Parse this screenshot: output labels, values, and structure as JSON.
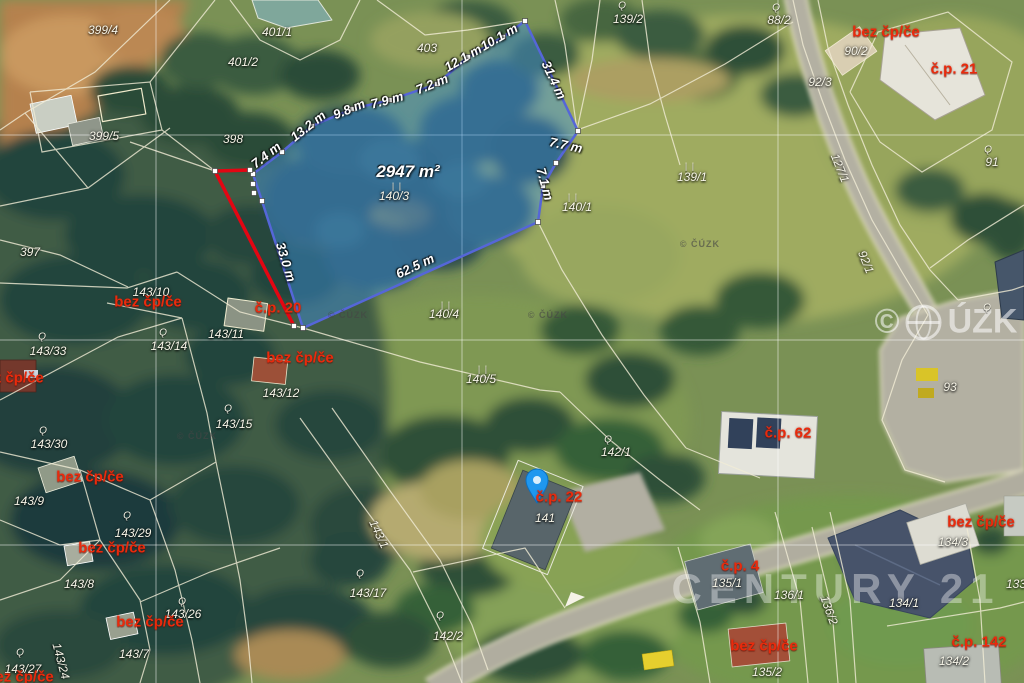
{
  "map": {
    "area_label": "2947 m²",
    "parcel_labels": [
      {
        "text": "399/4",
        "x": 103,
        "y": 30
      },
      {
        "text": "401/1",
        "x": 277,
        "y": 32
      },
      {
        "text": "401/2",
        "x": 243,
        "y": 62
      },
      {
        "text": "403",
        "x": 427,
        "y": 48
      },
      {
        "text": "399/5",
        "x": 104,
        "y": 136
      },
      {
        "text": "398",
        "x": 233,
        "y": 139
      },
      {
        "text": "397",
        "x": 30,
        "y": 252
      },
      {
        "text": "139/2",
        "x": 628,
        "y": 19
      },
      {
        "text": "88/2",
        "x": 779,
        "y": 20
      },
      {
        "text": "90/2",
        "x": 856,
        "y": 51
      },
      {
        "text": "92/3",
        "x": 820,
        "y": 82
      },
      {
        "text": "91",
        "x": 992,
        "y": 162
      },
      {
        "text": "139/1",
        "x": 692,
        "y": 177
      },
      {
        "text": "127/1",
        "x": 840,
        "y": 168,
        "rot": 68
      },
      {
        "text": "92/1",
        "x": 866,
        "y": 262,
        "rot": 68
      },
      {
        "text": "140/3",
        "x": 394,
        "y": 196
      },
      {
        "text": "140/1",
        "x": 577,
        "y": 207
      },
      {
        "text": "140/4",
        "x": 444,
        "y": 314
      },
      {
        "text": "140/5",
        "x": 481,
        "y": 379
      },
      {
        "text": "143/10",
        "x": 151,
        "y": 292
      },
      {
        "text": "143/11",
        "x": 226,
        "y": 334
      },
      {
        "text": "143/33",
        "x": 48,
        "y": 351
      },
      {
        "text": "143/14",
        "x": 169,
        "y": 346
      },
      {
        "text": "143/12",
        "x": 281,
        "y": 393
      },
      {
        "text": "143/15",
        "x": 234,
        "y": 424
      },
      {
        "text": "143/30",
        "x": 49,
        "y": 444
      },
      {
        "text": "143/9",
        "x": 29,
        "y": 501
      },
      {
        "text": "143/29",
        "x": 133,
        "y": 533
      },
      {
        "text": "143/8",
        "x": 79,
        "y": 584
      },
      {
        "text": "143/26",
        "x": 183,
        "y": 614
      },
      {
        "text": "143/7",
        "x": 134,
        "y": 654
      },
      {
        "text": "143/27",
        "x": 23,
        "y": 669
      },
      {
        "text": "143/24",
        "x": 61,
        "y": 661,
        "rot": 75
      },
      {
        "text": "143/1",
        "x": 379,
        "y": 534,
        "rot": 65
      },
      {
        "text": "143/17",
        "x": 368,
        "y": 593
      },
      {
        "text": "142/1",
        "x": 616,
        "y": 452
      },
      {
        "text": "142/2",
        "x": 448,
        "y": 636
      },
      {
        "text": "141",
        "x": 545,
        "y": 518
      },
      {
        "text": "135/1",
        "x": 727,
        "y": 583
      },
      {
        "text": "136/1",
        "x": 789,
        "y": 595
      },
      {
        "text": "136/2",
        "x": 829,
        "y": 610,
        "rot": 70
      },
      {
        "text": "134/1",
        "x": 904,
        "y": 603
      },
      {
        "text": "134/3",
        "x": 953,
        "y": 542
      },
      {
        "text": "134/2",
        "x": 954,
        "y": 661
      },
      {
        "text": "135/2",
        "x": 767,
        "y": 672
      },
      {
        "text": "133",
        "x": 1016,
        "y": 584
      },
      {
        "text": "93",
        "x": 950,
        "y": 387
      }
    ],
    "red_labels": [
      {
        "text": "bez čp/če",
        "x": 886,
        "y": 32
      },
      {
        "text": "č.p. 21",
        "x": 954,
        "y": 69
      },
      {
        "text": "bez čp/če",
        "x": 148,
        "y": 302
      },
      {
        "text": "č.p. 20",
        "x": 278,
        "y": 308
      },
      {
        "text": "bez čp/če",
        "x": 300,
        "y": 358
      },
      {
        "text": "bez čp/če",
        "x": 10,
        "y": 378
      },
      {
        "text": "bez čp/če",
        "x": 90,
        "y": 477
      },
      {
        "text": "bez čp/če",
        "x": 112,
        "y": 548
      },
      {
        "text": "bez čp/če",
        "x": 150,
        "y": 622
      },
      {
        "text": "bez čp/če",
        "x": 20,
        "y": 677
      },
      {
        "text": "č.p. 62",
        "x": 788,
        "y": 433
      },
      {
        "text": "č.p. 22",
        "x": 559,
        "y": 497
      },
      {
        "text": "č.p. 4",
        "x": 740,
        "y": 566
      },
      {
        "text": "bez čp/če",
        "x": 981,
        "y": 522
      },
      {
        "text": "bez čp/če",
        "x": 764,
        "y": 646
      },
      {
        "text": "č.p. 142",
        "x": 979,
        "y": 642
      }
    ],
    "dimension_labels": [
      {
        "text": "7.4 m",
        "x": 266,
        "y": 155,
        "rot": -38
      },
      {
        "text": "13.2 m",
        "x": 308,
        "y": 126,
        "rot": -38
      },
      {
        "text": "9.8 m",
        "x": 349,
        "y": 109,
        "rot": -22
      },
      {
        "text": "7.9 m",
        "x": 387,
        "y": 100,
        "rot": -15
      },
      {
        "text": "7.2 m",
        "x": 432,
        "y": 84,
        "rot": -22
      },
      {
        "text": "12.1 m",
        "x": 463,
        "y": 58,
        "rot": -30
      },
      {
        "text": "10.1 m",
        "x": 499,
        "y": 37,
        "rot": -30
      },
      {
        "text": "31.4 m",
        "x": 554,
        "y": 80,
        "rot": 65
      },
      {
        "text": "7.7 m",
        "x": 566,
        "y": 145,
        "rot": 12
      },
      {
        "text": "7.1 m",
        "x": 545,
        "y": 184,
        "rot": 75
      },
      {
        "text": "62.5 m",
        "x": 415,
        "y": 266,
        "rot": -25
      },
      {
        "text": "33.0 m",
        "x": 286,
        "y": 262,
        "rot": 73
      }
    ],
    "symbols": {
      "grass_glyph": "| |",
      "grass_positions": [
        {
          "x": 397,
          "y": 186
        },
        {
          "x": 446,
          "y": 305
        },
        {
          "x": 483,
          "y": 369
        },
        {
          "x": 690,
          "y": 166
        },
        {
          "x": 573,
          "y": 197
        }
      ],
      "building_glyph": "Ǫ",
      "building_positions": [
        {
          "x": 622,
          "y": 6
        },
        {
          "x": 776,
          "y": 8
        },
        {
          "x": 988,
          "y": 150
        },
        {
          "x": 42,
          "y": 337
        },
        {
          "x": 163,
          "y": 333
        },
        {
          "x": 43,
          "y": 431
        },
        {
          "x": 228,
          "y": 409
        },
        {
          "x": 127,
          "y": 516
        },
        {
          "x": 182,
          "y": 602
        },
        {
          "x": 20,
          "y": 653
        },
        {
          "x": 360,
          "y": 574
        },
        {
          "x": 440,
          "y": 616
        },
        {
          "x": 608,
          "y": 440
        },
        {
          "x": 987,
          "y": 308
        }
      ]
    },
    "watermarks": {
      "small": {
        "text": "© ČÚZK",
        "positions": [
          {
            "x": 348,
            "y": 315
          },
          {
            "x": 548,
            "y": 315
          },
          {
            "x": 197,
            "y": 436
          },
          {
            "x": 700,
            "y": 244
          }
        ]
      },
      "large": {
        "prefix": "©",
        "text": "ÚZK",
        "x": 946,
        "y": 322
      },
      "brand": {
        "text": "CENTURY 21",
        "x": 836,
        "y": 589
      }
    },
    "colors": {
      "highlight_fill": "#4092e1",
      "highlight_stroke": "#5566d8",
      "red_line": "#e30613",
      "boundary_line": "#f2edd6",
      "red_label": "#ea2a0c",
      "white_label": "#f7f5e8"
    }
  }
}
